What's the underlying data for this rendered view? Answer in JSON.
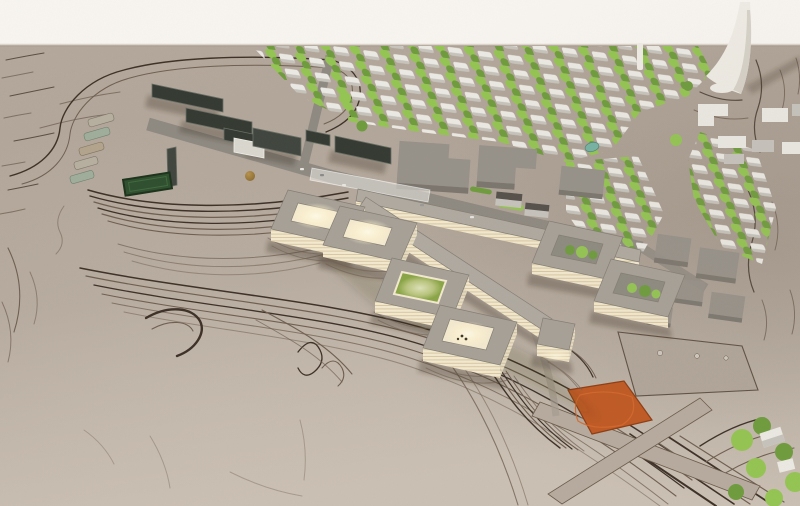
{
  "meta": {
    "type": "photograph",
    "subject": "Aerial photograph of an architectural scale model: a masterplan with a zig-zag courtyard building complex lit from within, dark station slabs, bus bays, a housing grid with trees, a white spire sculpture and an orange field on contoured clay terrain",
    "view": "oblique aerial"
  },
  "palette": {
    "backdrop": "#f8f5f1",
    "terrain": "#b4a89c",
    "terrainLight": "#cbc0b4",
    "terrainDark": "#9d9185",
    "contour": "#6f6052",
    "contourDark": "#3e3228",
    "road": "#8f8a82",
    "roadLight": "#a89d91",
    "slab": "#353a33",
    "slabTop": "#6a6f66",
    "slabBlock": "#41463f",
    "whiteRoof": "#dad7cf",
    "field": "#2f5030",
    "fieldDark": "#1c331c",
    "busA": "#b7af9f",
    "busB": "#9fae9b",
    "busC": "#b3a48e",
    "roof": "#a7a198",
    "roofLight": "#b0aaa1",
    "roofEdge": "#847e74",
    "wall": "#f4ead0",
    "wallLine": "#d9c9a3",
    "glow": "#fff3cf",
    "courtGreen": "#8aa647",
    "tree": "#94c553",
    "treeDark": "#6f9c3d",
    "house": "#eceae4",
    "houseShade": "#c7c4bd",
    "blockTop": "#97928a",
    "blockSide": "#7b766e",
    "roofDark": "#55504b",
    "orange": "#c05a24",
    "orangeDark": "#8e3d14",
    "spire": "#efece5",
    "spireShade": "#d7d2c8",
    "dome": "#8a6c32",
    "teal": "#76b3a4",
    "shadow": "rgba(58,45,30,0.30)"
  },
  "scene": {
    "elements": [
      {
        "name": "backdrop",
        "desc": "white studio backdrop above model edge"
      },
      {
        "name": "terrain-base",
        "desc": "clay terrain board with carved contour lines"
      },
      {
        "name": "hospital-complex",
        "desc": "chain of gray courtyard rings with glowing lit courtyards"
      },
      {
        "name": "station-buildings",
        "desc": "long dark slab buildings along a road"
      },
      {
        "name": "bus-parking",
        "desc": "row of parked buses"
      },
      {
        "name": "sports-field",
        "desc": "dark green pitch"
      },
      {
        "name": "housing-grid",
        "desc": "rows of small white houses with tree lines"
      },
      {
        "name": "existing-town-blocks",
        "desc": "gray flat-roof building blocks"
      },
      {
        "name": "church-spire",
        "desc": "white organic spire sculpture"
      },
      {
        "name": "orange-field",
        "desc": "orange square sports court"
      },
      {
        "name": "plaza",
        "desc": "raised flat plaza with boulders"
      },
      {
        "name": "footpaths",
        "desc": "crossing footpaths"
      },
      {
        "name": "dome-structure",
        "desc": "small gold dome at the station forecourt"
      },
      {
        "name": "teal-pond",
        "desc": "small teal element"
      }
    ]
  }
}
